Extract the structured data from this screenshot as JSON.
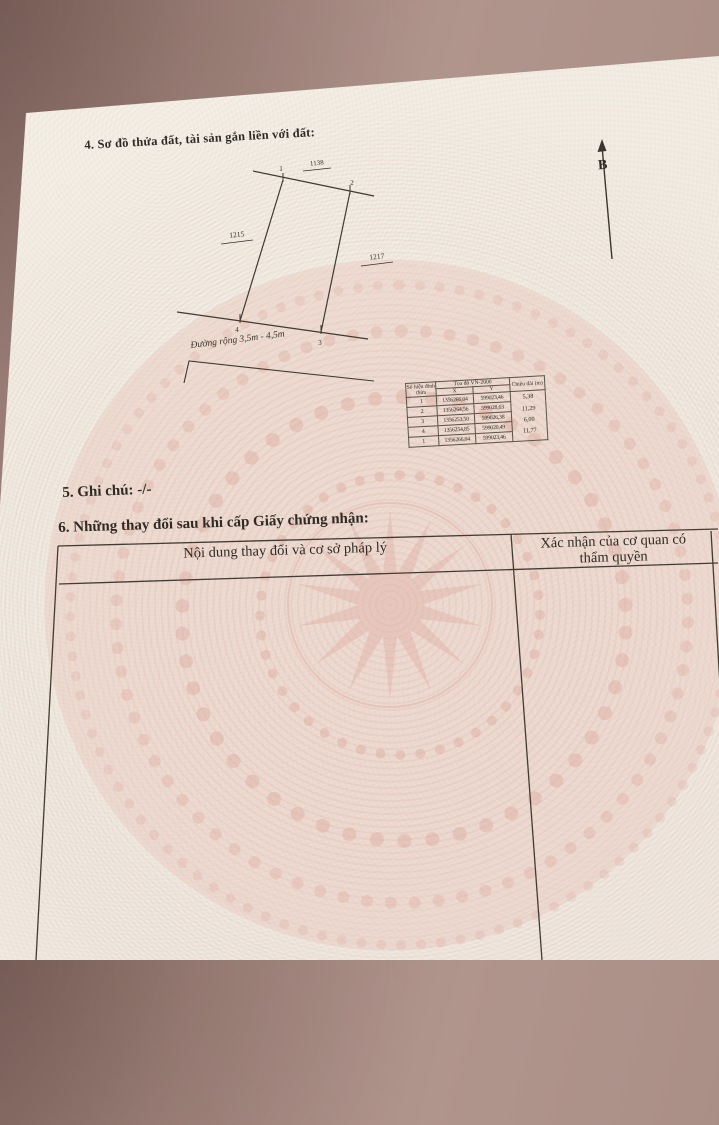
{
  "page": {
    "section4_title": "4. Sơ đồ thửa đất, tài sản gắn liền với đất:",
    "section5_text": "5. Ghi chú: -/-",
    "section6_title": "6. Những thay đổi sau khi cấp Giấy chứng nhận:"
  },
  "compass": {
    "north_label": "B"
  },
  "diagram": {
    "adjacent_parcel_top": "1138",
    "adjacent_parcel_left": "1215",
    "adjacent_parcel_right": "1217",
    "vertex_labels": [
      "1",
      "2",
      "3",
      "4"
    ],
    "road_label": "Đường rộng 3,5m - 4,5m"
  },
  "coord_table": {
    "header": {
      "col_id": "Số hiệu đỉnh thửa",
      "col_coords": "Tọa độ VN-2000",
      "col_x": "X",
      "col_y": "Y",
      "col_length": "Chiều dài (m)"
    },
    "rows": [
      {
        "id": "1",
        "x": "1356266,04",
        "y": "599023,46"
      },
      {
        "id": "2",
        "x": "1356264,56",
        "y": "599028,63"
      },
      {
        "id": "3",
        "x": "1356253,50",
        "y": "599026,38"
      },
      {
        "id": "4",
        "x": "1356254,85",
        "y": "599020,49"
      },
      {
        "id": "1",
        "x": "1356266,04",
        "y": "599023,46"
      }
    ],
    "lengths": [
      "5,38",
      "11,29",
      "6,00",
      "11,77"
    ]
  },
  "changes_table": {
    "col1_header": "Nội dung thay đổi và cơ sở pháp lý",
    "col2_header": "Xác nhận của cơ quan có thẩm quyền"
  },
  "colors": {
    "fabric": "#a98e86",
    "paper": "#f1ece2",
    "watermark_pink": "#ddA79b",
    "ink": "#2f2b24"
  }
}
